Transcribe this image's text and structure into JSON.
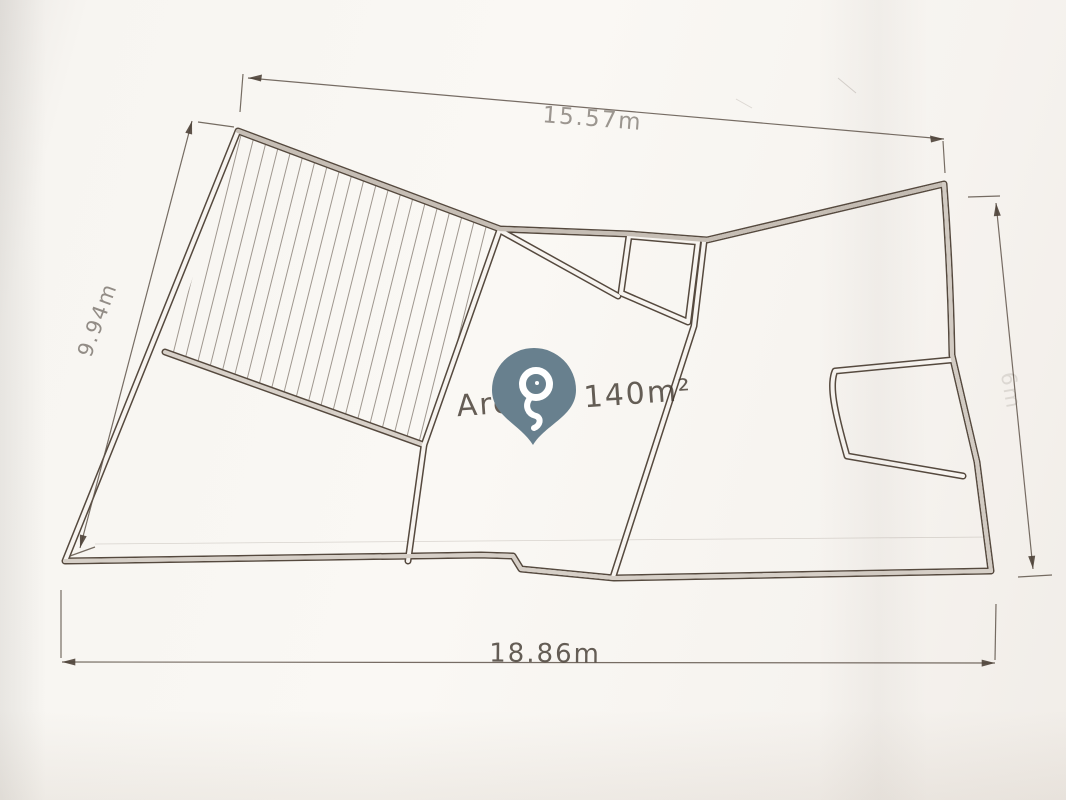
{
  "page": {
    "kind": "scanned hand-drawn floor plan sketch"
  },
  "plan": {
    "area_label": "Area = 140m²",
    "dimensions": {
      "top": "15.57m",
      "left": "9.94m",
      "bottom": "18.86m",
      "right_faint": "6m"
    }
  },
  "icons": {
    "pin": "location-pin"
  },
  "colors": {
    "paper": "#f7f4f0",
    "pencil": "#4e4339",
    "wall_core_gray": "#c6beb5",
    "pin_fill": "#68808e"
  }
}
